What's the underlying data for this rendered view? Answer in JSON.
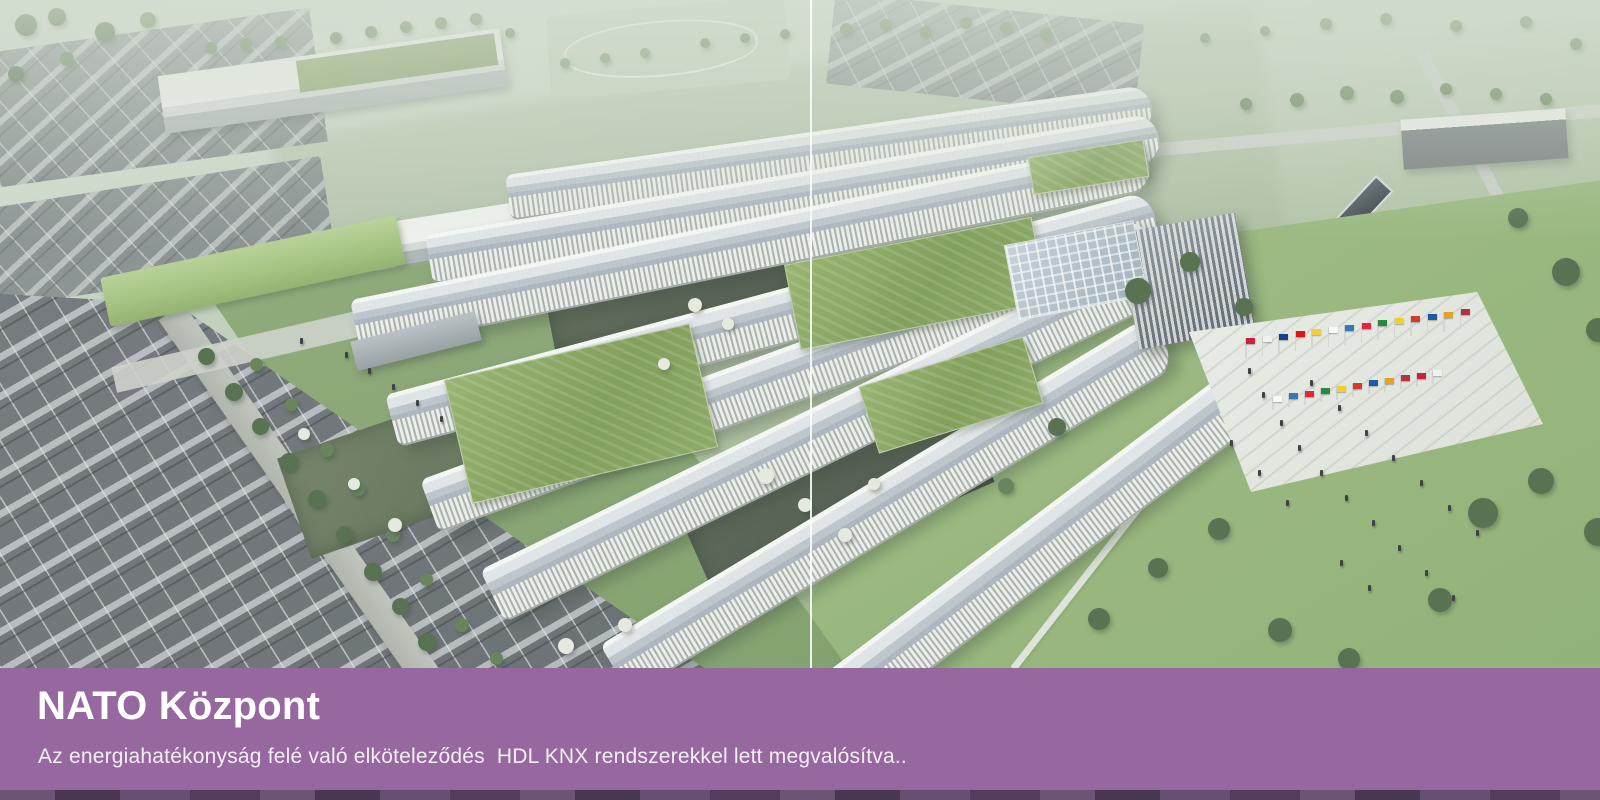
{
  "banner": {
    "title": "NATO Központ",
    "subtitle": "Az energiahatékonyság felé való elköteleződés  HDL KNX rendszerekkel lett megvalósítva.."
  },
  "scene": {
    "description": "Aerial architectural rendering of the NATO headquarters campus with fanned white wings, green roofs, parking lots, lawns and a flag plaza"
  },
  "colors": {
    "banner_bg": "#96689f",
    "banner_footer": "#5d4769",
    "text": "#ffffff",
    "backdrop": "#ccd9ca",
    "lawn": "#9cba7e",
    "roof_green": "#85a35b",
    "building_roof": "#b3bcc6",
    "building_facade": "#eceeec",
    "asphalt": "#676d73"
  }
}
